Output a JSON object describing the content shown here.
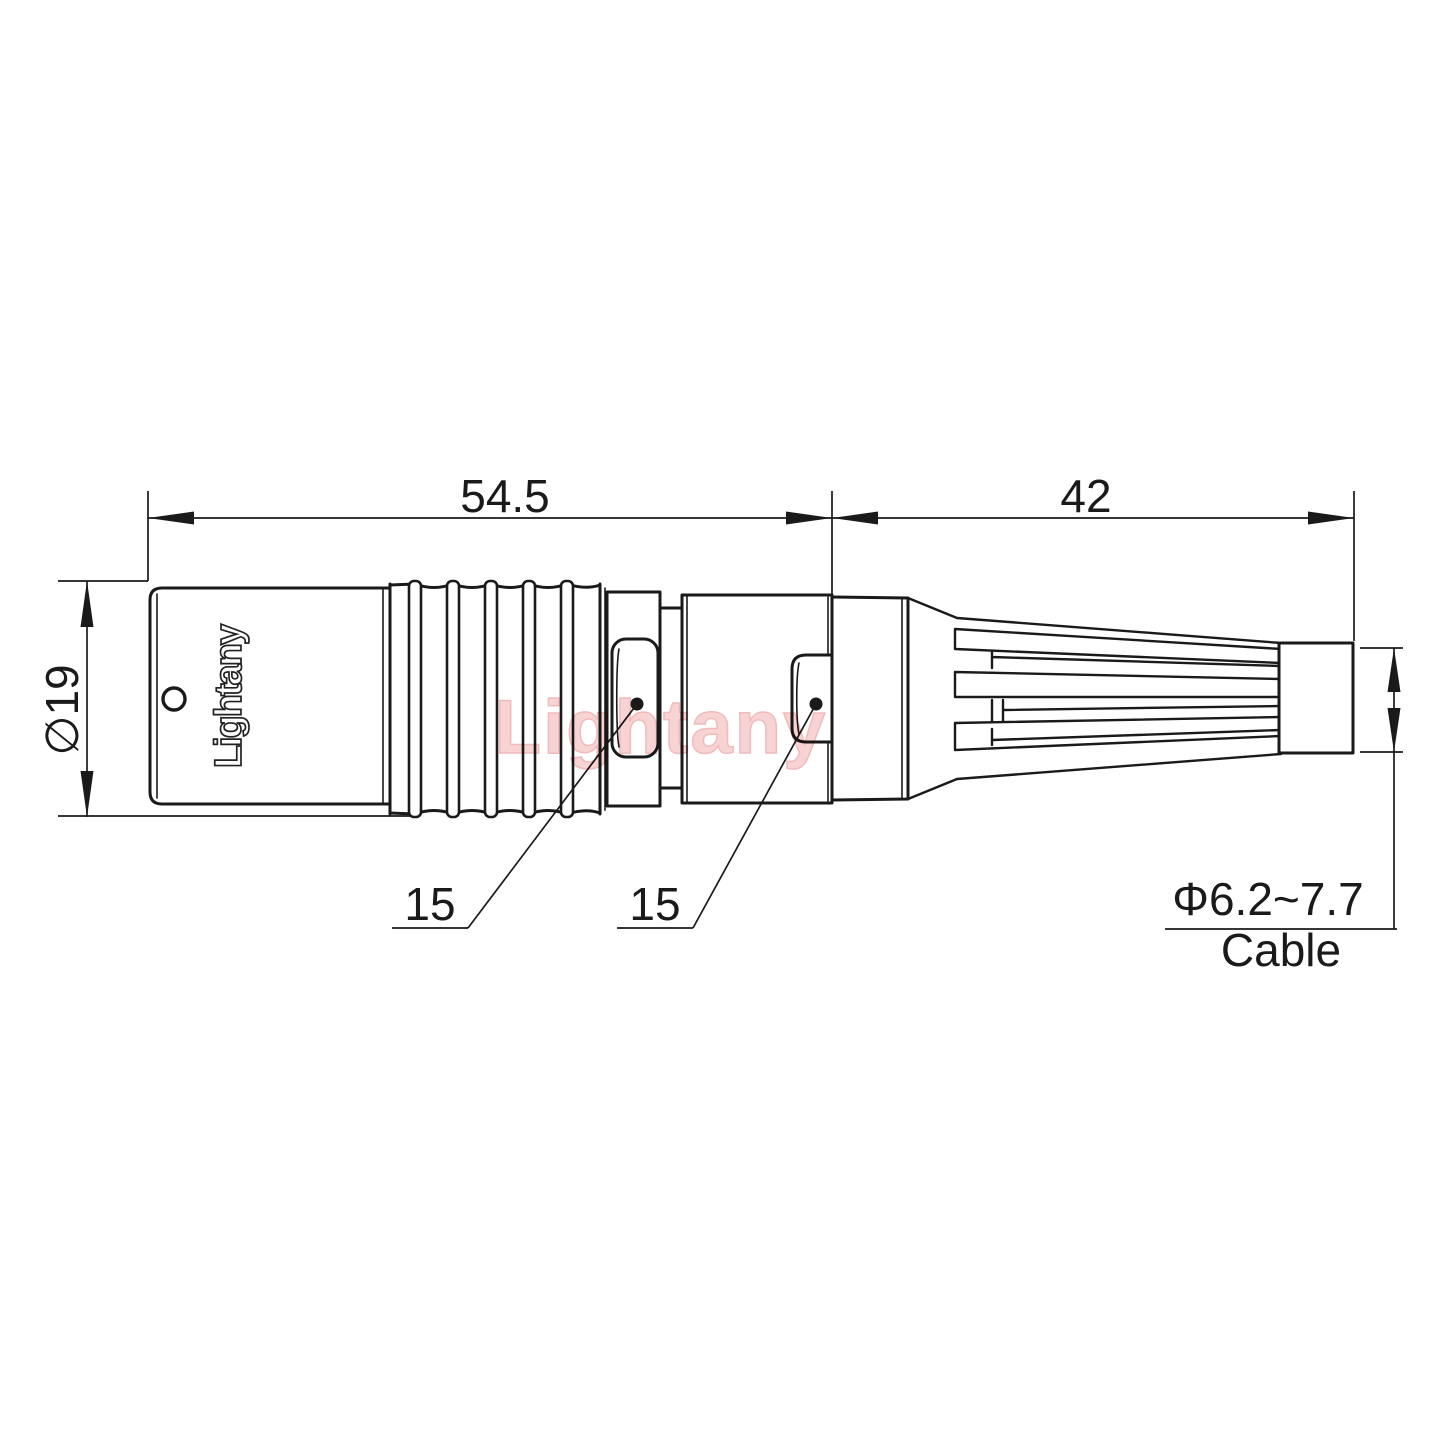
{
  "drawing": {
    "watermark_text": "Lightany",
    "engraving_text": "Lightany",
    "line_color": "#1a1a1a",
    "watermark_color": "#f7cccc",
    "background_color": "#ffffff"
  },
  "dimensions": {
    "front_length": "54.5",
    "back_length": "42",
    "body_diameter": "∅19",
    "front_wrench_flat": "15",
    "back_wrench_flat": "15",
    "cable_diameter_range": "Φ6.2~7.7",
    "cable_label": "Cable"
  }
}
